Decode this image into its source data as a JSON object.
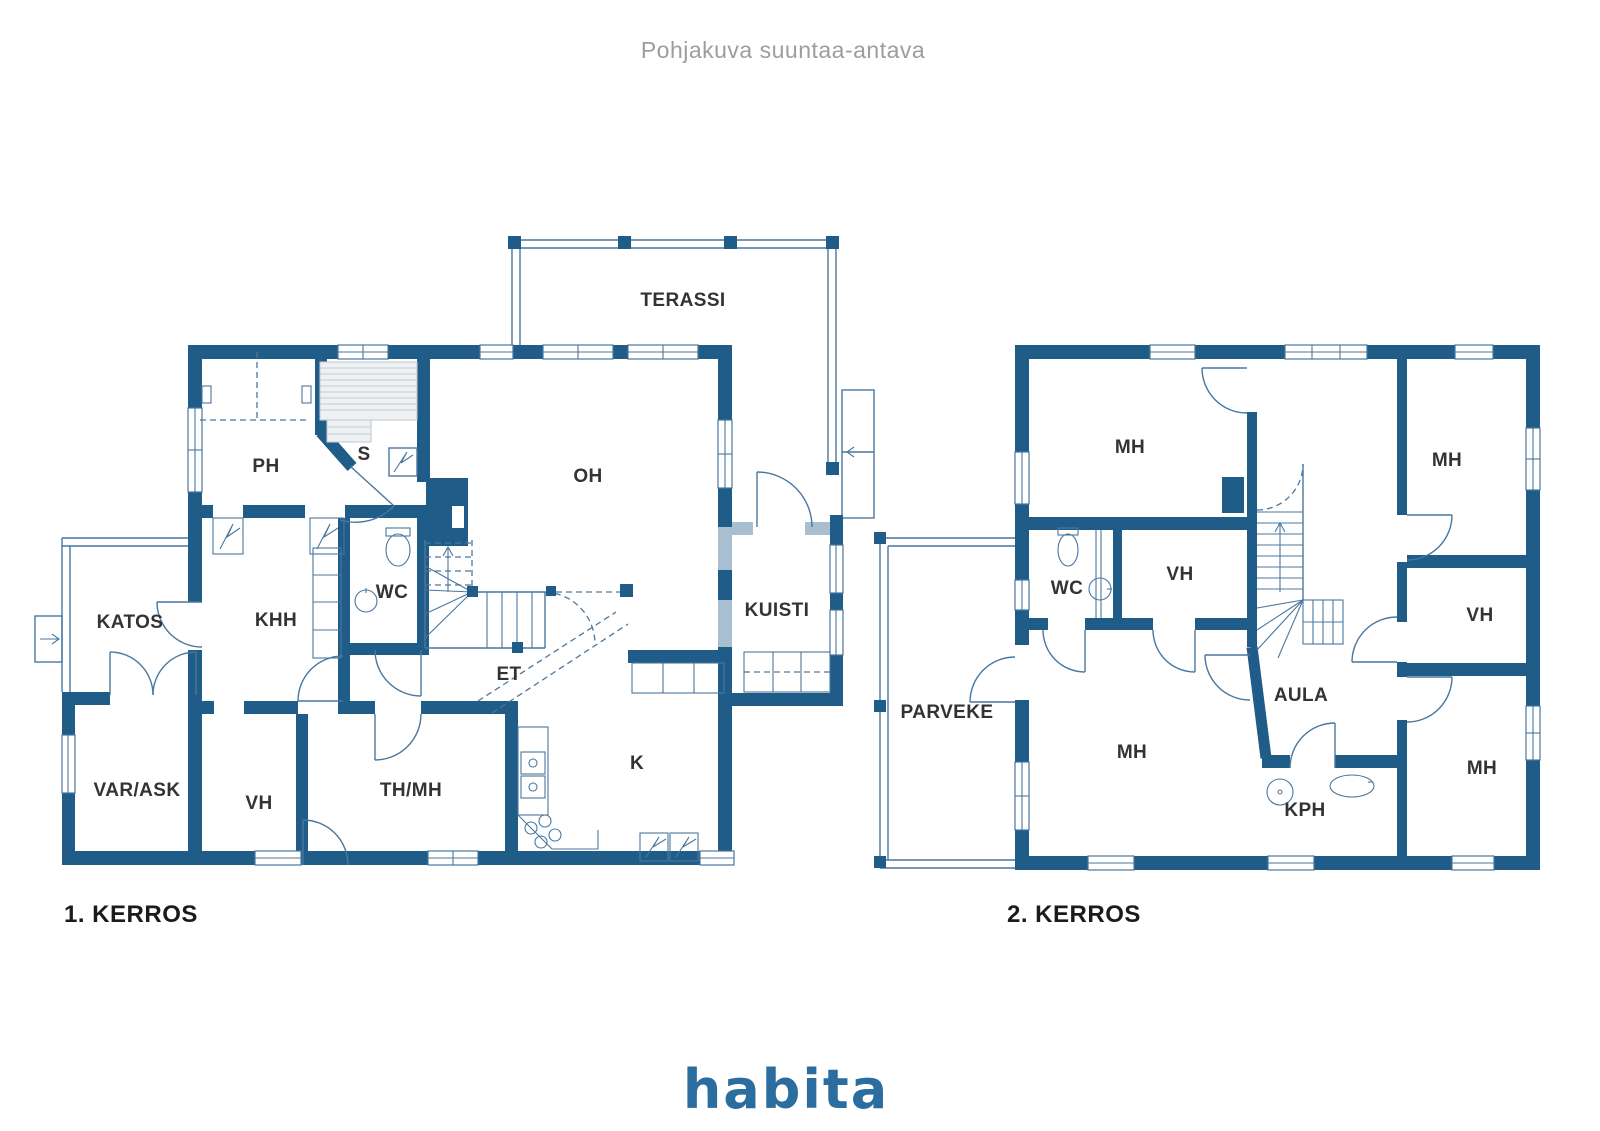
{
  "title": "Pohjakuva suuntaa-antava",
  "branding": {
    "logo_text": "habita",
    "logo_color": "#2a6d9e"
  },
  "colors": {
    "wall": "#1f5c87",
    "wall_light": "#a7bfd1",
    "thin_line": "#49779f",
    "label_text": "#333333",
    "title_text": "#9d9d9d"
  },
  "floor1": {
    "label": "1. KERROS",
    "rooms": {
      "terassi": "TERASSI",
      "ph": "PH",
      "s": "S",
      "oh": "OH",
      "katos": "KATOS",
      "khh": "KHH",
      "wc": "WC",
      "kuisti": "KUISTI",
      "et": "ET",
      "var_ask": "VAR/ASK",
      "vh": "VH",
      "th_mh": "TH/MH",
      "k": "K"
    }
  },
  "floor2": {
    "label": "2. KERROS",
    "rooms": {
      "mh_top_left": "MH",
      "mh_top_right": "MH",
      "wc": "WC",
      "vh_center": "VH",
      "vh_right": "VH",
      "parveke": "PARVEKE",
      "mh_bottom": "MH",
      "aula": "AULA",
      "kph": "KPH",
      "mh_bottom_right": "MH"
    }
  }
}
